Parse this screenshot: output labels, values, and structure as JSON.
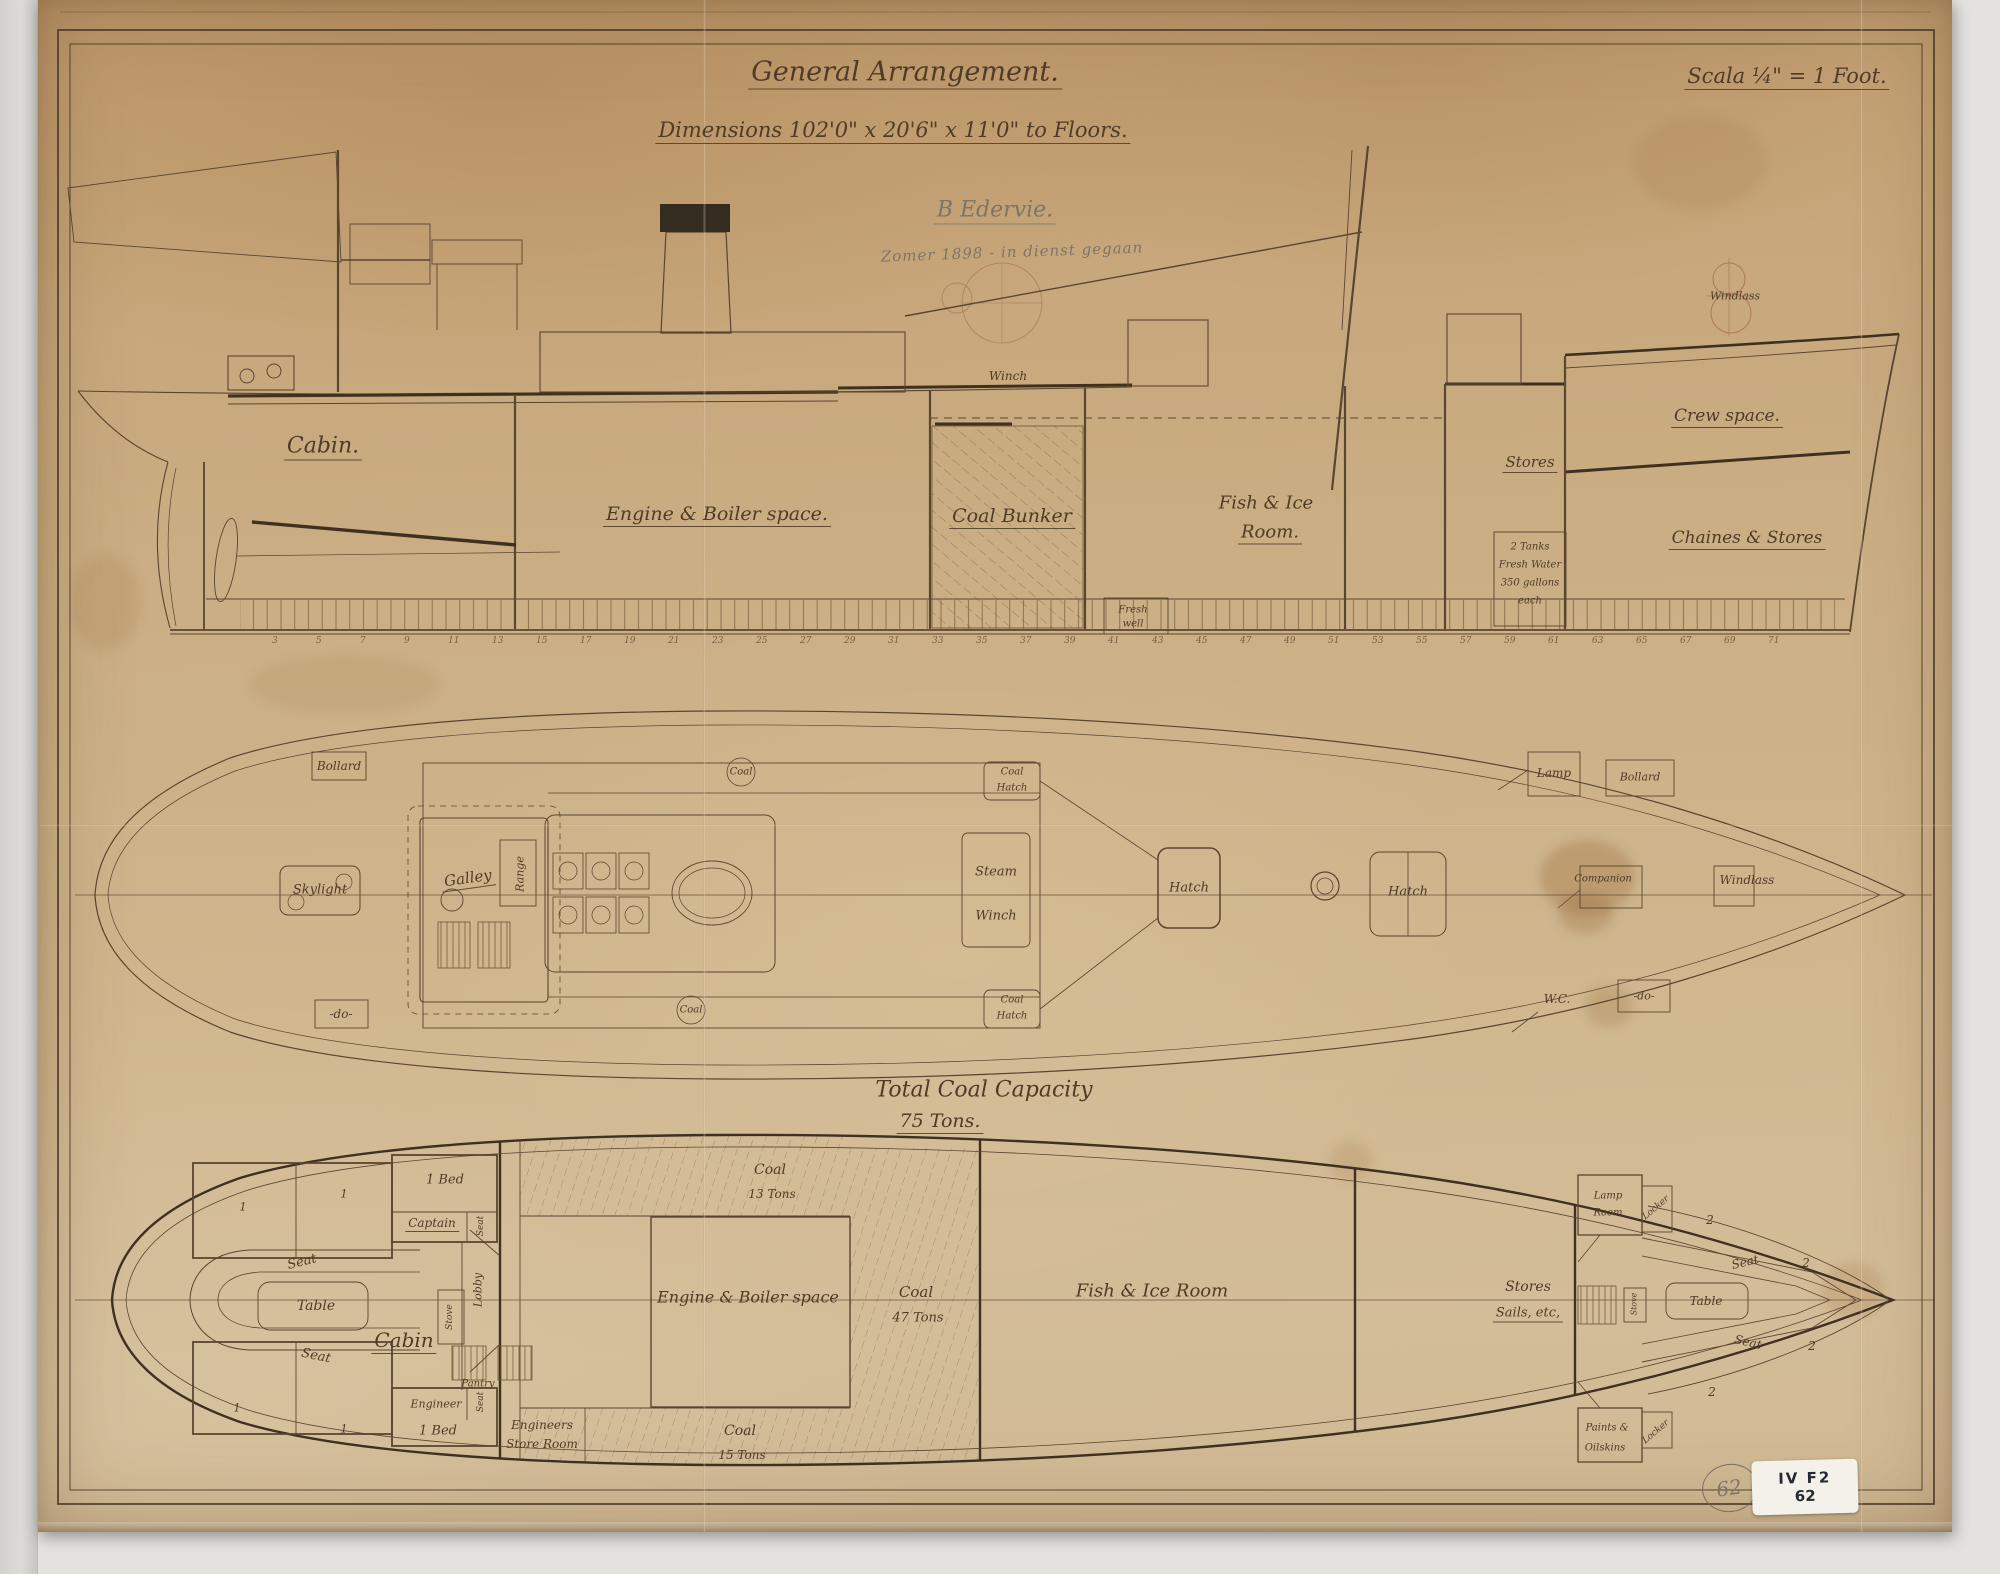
{
  "titles": {
    "general": "General Arrangement.",
    "dimensions": "Dimensions 102'0\" x 20'6\" x 11'0\" to Floors.",
    "scale": "Scala ¼\" = 1 Foot.",
    "pencil_name": "B Edervie.",
    "pencil_note": "Zomer 1898 - in dienst gegaan"
  },
  "elevation": {
    "labels": {
      "cabin": "Cabin.",
      "engine_boiler": "Engine & Boiler space.",
      "coal_bunker": "Coal Bunker",
      "fish_ice_1": "Fish & Ice",
      "fish_ice_2": "Room.",
      "winch": "Winch",
      "stores": "Stores",
      "crew_space": "Crew space.",
      "chains_stores": "Chaines & Stores",
      "windlass": "Windlass"
    },
    "tanks": {
      "line1": "2 Tanks",
      "line2": "Fresh Water",
      "line3": "350 gallons",
      "line4": "each"
    },
    "fresh_well": {
      "line1": "Fresh",
      "line2": "well"
    },
    "frame_numbers": [
      "3",
      "5",
      "7",
      "9",
      "11",
      "13",
      "15",
      "17",
      "19",
      "21",
      "23",
      "25",
      "27",
      "29",
      "31",
      "33",
      "35",
      "37",
      "39",
      "41",
      "43",
      "45",
      "47",
      "49",
      "51",
      "53",
      "55",
      "57",
      "59",
      "61",
      "63",
      "65",
      "67",
      "69",
      "71"
    ]
  },
  "deck_plan": {
    "labels": {
      "bollard_aft": "Bollard",
      "ditto_aft": "-do-",
      "skylight": "Skylight",
      "galley": "Galley",
      "range": "Range",
      "coal": "Coal",
      "coal_hatch_1": "Coal",
      "coal_hatch_2": "Hatch",
      "steam": "Steam",
      "winch": "Winch",
      "hatch": "Hatch",
      "lamp": "Lamp",
      "bollard_fore": "Bollard",
      "companion": "Companion",
      "windlass": "Windlass",
      "wc": "W.C.",
      "ditto_fore": "-do-"
    }
  },
  "coal_capacity": {
    "line1": "Total Coal Capacity",
    "line2": "75 Tons."
  },
  "lower_plan": {
    "labels": {
      "bed": "1 Bed",
      "captain": "Captain",
      "seat": "Seat",
      "table": "Table",
      "cabin": "Cabin",
      "stove": "Stove",
      "lobby": "Lobby",
      "pantry": "Pantry",
      "engineer": "Engineer",
      "engineers_store_1": "Engineers",
      "engineers_store_2": "Store Room",
      "engine_boiler": "Engine & Boiler space",
      "coal": "Coal",
      "coal13": "13 Tons",
      "coal47": "47 Tons",
      "coal15": "15 Tons",
      "fish_ice": "Fish & Ice Room",
      "stores": "Stores",
      "sails_etc": "Sails, etc,",
      "lamp_room_1": "Lamp",
      "lamp_room_2": "Room",
      "locker": "Locker",
      "paints_1": "Paints &",
      "paints_2": "Oilskins",
      "berth_one": "1",
      "berth_two": "2"
    }
  },
  "stamps": {
    "pencil_number": "62",
    "sticker_line1": "IV F2",
    "sticker_line2": "62"
  }
}
